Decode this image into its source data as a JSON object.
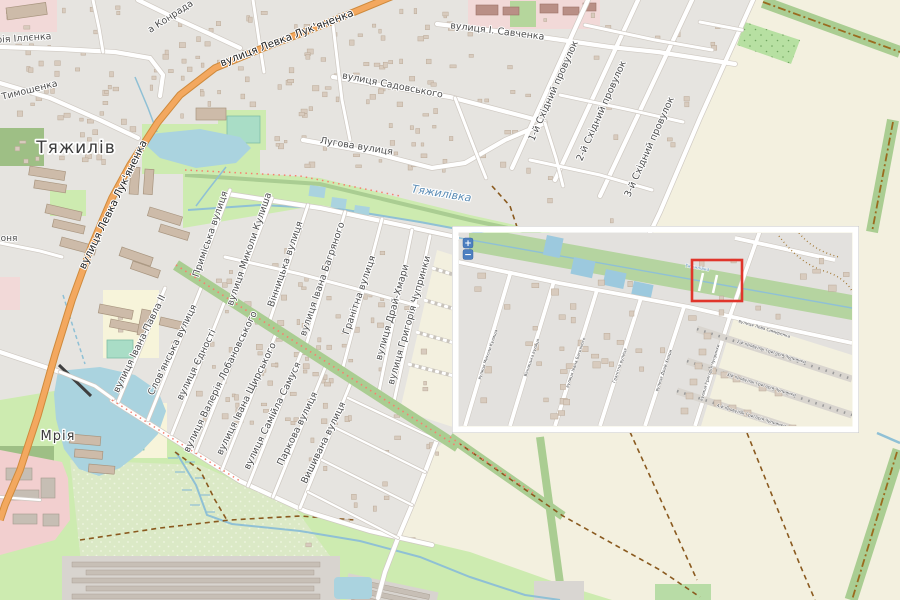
{
  "map": {
    "place_labels": [
      {
        "t": "Тяжилів",
        "x": 76,
        "y": 153,
        "s": 17
      },
      {
        "t": "Мрія",
        "x": 58,
        "y": 440,
        "s": 13
      }
    ],
    "water_label": {
      "t": "Тяжилівка",
      "x": 441,
      "y": 197,
      "r": 9,
      "s": 11
    },
    "road_labels": [
      {
        "t": "вулиця Левка Лук'яненка",
        "x": 288,
        "y": 41,
        "r": -21,
        "s": 10.5,
        "c": "#222222"
      },
      {
        "t": "вулиця Левка Лук'яненка",
        "x": 116,
        "y": 206,
        "r": -64,
        "s": 10.5,
        "c": "#222222"
      },
      {
        "t": "рія Іллєнка",
        "x": 24,
        "y": 41,
        "r": -4
      },
      {
        "t": "а Тимошенка",
        "x": 26,
        "y": 94,
        "r": -14
      },
      {
        "t": "а Конрада",
        "x": 172,
        "y": 19,
        "r": -33
      },
      {
        "t": "вулиця І. Савченка",
        "x": 497,
        "y": 34,
        "r": 7
      },
      {
        "t": "вулиця Садовського",
        "x": 392,
        "y": 88,
        "r": 11
      },
      {
        "t": "Лугова вулиця",
        "x": 356,
        "y": 149,
        "r": 9
      },
      {
        "t": "1-й Східний провулок",
        "x": 556,
        "y": 92,
        "r": -66
      },
      {
        "t": "2-й Східний провулок",
        "x": 604,
        "y": 112,
        "r": -66
      },
      {
        "t": "3-й Східний провулок",
        "x": 652,
        "y": 148,
        "r": -66
      },
      {
        "t": "Приміська вулиця",
        "x": 213,
        "y": 235,
        "r": -71
      },
      {
        "t": "вулиця Миколи Кулиша",
        "x": 252,
        "y": 250,
        "r": -71
      },
      {
        "t": "Вінницька вулиця",
        "x": 288,
        "y": 265,
        "r": -71
      },
      {
        "t": "вулиця Івана Багряного",
        "x": 325,
        "y": 280,
        "r": -71
      },
      {
        "t": "Гранітна вулиця",
        "x": 362,
        "y": 296,
        "r": -71
      },
      {
        "t": "вулиця Драй-Хмари",
        "x": 395,
        "y": 313,
        "r": -74
      },
      {
        "t": "вулиця Григорія Чупринки",
        "x": 412,
        "y": 321,
        "r": -74
      },
      {
        "t": "вулиця Івана-Павла II",
        "x": 142,
        "y": 345,
        "r": -64
      },
      {
        "t": "Слов'янська вулиця",
        "x": 175,
        "y": 351,
        "r": -64
      },
      {
        "t": "вулиця Єдності",
        "x": 199,
        "y": 366,
        "r": -64
      },
      {
        "t": "вулиця Валерія Лобановського",
        "x": 223,
        "y": 383,
        "r": -64
      },
      {
        "t": "вулиця Івана Щирського",
        "x": 249,
        "y": 400,
        "r": -64
      },
      {
        "t": "вулиця Самійла Самуся",
        "x": 275,
        "y": 417,
        "r": -64
      },
      {
        "t": "Паркова вулиця",
        "x": 300,
        "y": 430,
        "r": -64
      },
      {
        "t": "Вишивана вулиця",
        "x": 326,
        "y": 444,
        "r": -64
      },
      {
        "t": "оня",
        "x": 9,
        "y": 241,
        "r": 0,
        "s": 9
      }
    ],
    "inset": {
      "street_labels": [
        {
          "t": "вулиця Миколи Кулиша",
          "x": 30,
          "y": 122,
          "r": -71
        },
        {
          "t": "Вінницька вулиця",
          "x": 74,
          "y": 125,
          "r": -71
        },
        {
          "t": "вулиця Івана Багряного",
          "x": 118,
          "y": 130,
          "r": -71
        },
        {
          "t": "Гранітна вулиця",
          "x": 162,
          "y": 133,
          "r": -71
        },
        {
          "t": "вулиця Драй-Хмари",
          "x": 206,
          "y": 138,
          "r": -71
        },
        {
          "t": "вулиця Григорія Чупринки",
          "x": 252,
          "y": 140,
          "r": -73
        },
        {
          "t": "вулиця Лева Симиренка",
          "x": 305,
          "y": 97,
          "r": 17
        },
        {
          "t": "2-й провулок Григорія Чупринки",
          "x": 312,
          "y": 120,
          "r": 17
        },
        {
          "t": "3-й провулок Григорія Чупринки",
          "x": 302,
          "y": 153,
          "r": 17
        },
        {
          "t": "4-й провулок Григорія Чупринки",
          "x": 292,
          "y": 184,
          "r": 17
        }
      ],
      "water_label": {
        "t": "Тяжилівка",
        "x": 238,
        "y": 36,
        "r": 10,
        "s": 4.5
      },
      "highlight": {
        "x": 233,
        "y": 27,
        "w": 50,
        "h": 41
      },
      "controls": {
        "zoom_in_label": "+",
        "zoom_out_label": "−"
      }
    }
  },
  "colors": {
    "residential": "#e6e4e0",
    "farmland": "#f3f0df",
    "grass": "#cdebb0",
    "scrub": "#dbe9c6",
    "forest": "#9ebf85",
    "tree_row": "#aacd92",
    "water": "#aad3df",
    "stream": "#8fc0d5",
    "road_fill": "#ffffff",
    "road_casing": "#cfc9c2",
    "primary_road": "#f3a85f",
    "primary_casing": "#cf8a3c",
    "school": "#f7f4da",
    "pitch": "#a9ddc6",
    "hospital_pink": "#f2d9d8",
    "industrial_pink": "#f2cfcf",
    "building": "#d8cbbe",
    "building_outline": "#bcab99",
    "apartment": "#cdbba9",
    "apartment_outline": "#a8957f",
    "boundary": "#9a6b1f",
    "track": "#8a5a1f",
    "footway": "#f77f6f",
    "highlight_red": "#e0352b",
    "control_blue": "#4d7fc0",
    "label": "#4d4d4d",
    "place_label": "#3c3c3c",
    "water_label": "#5a8cb5",
    "garage_bg": "#d8d4cf",
    "garage_row": "#c7bfb6",
    "construction": "#c9c4bc",
    "dam": "#3f3f3f",
    "orchard": "#b7e0a2",
    "orchard_dot": "#6fa35f"
  }
}
